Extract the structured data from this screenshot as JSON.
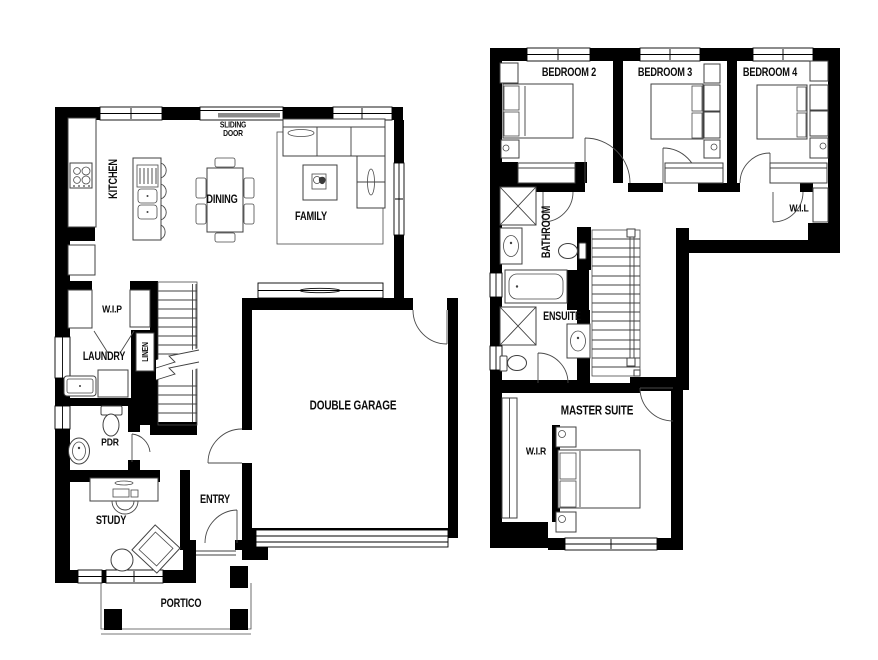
{
  "ground_floor": {
    "kitchen": "KITCHEN",
    "sliding_door_line1": "SLIDING",
    "sliding_door_line2": "DOOR",
    "dining": "DINING",
    "family": "FAMILY",
    "wip": "W.I.P",
    "laundry": "LAUNDRY",
    "linen": "LINEN",
    "pdr": "PDR",
    "study": "STUDY",
    "entry": "ENTRY",
    "double_garage": "DOUBLE GARAGE",
    "portico": "PORTICO"
  },
  "upper_floor": {
    "bedroom2": "BEDROOM 2",
    "bedroom3": "BEDROOM 3",
    "bedroom4": "BEDROOM 4",
    "bathroom": "BATHROOM",
    "wil": "W.I.L",
    "ensuite": "ENSUITE",
    "master_suite": "MASTER SUITE",
    "wir": "W.I.R"
  },
  "colors": {
    "wall": "#000000",
    "furniture_line": "#404040",
    "label": "#0c0c0c",
    "background": "#ffffff"
  }
}
